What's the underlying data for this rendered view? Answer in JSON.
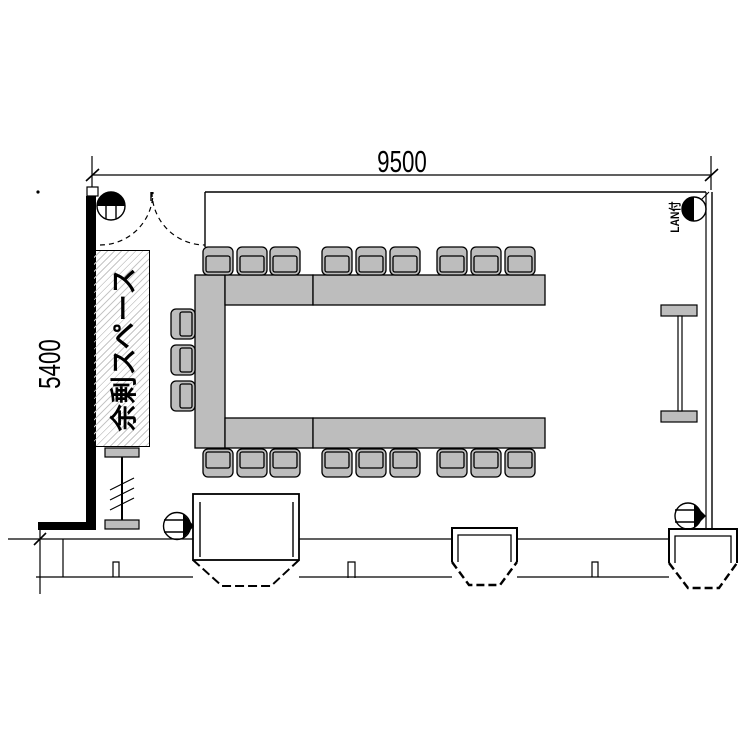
{
  "drawing_type": "meeting-room floor plan",
  "dimensions": {
    "width_label": "9500",
    "height_label": "5400"
  },
  "labels": {
    "surplus_space": "余剰スペース",
    "lan_port": "LAN付"
  },
  "colors": {
    "furniture": "#bdbdbd",
    "wall": "#000000",
    "hatch": "#c6c6c6",
    "background": "#ffffff"
  },
  "furniture": {
    "table_shape": "U-shape open to the right",
    "table_units": [
      [
        195,
        275,
        30,
        173
      ],
      [
        225,
        275,
        88,
        30
      ],
      [
        313,
        275,
        232,
        30
      ],
      [
        225,
        418,
        88,
        30
      ],
      [
        313,
        418,
        232,
        30
      ]
    ],
    "chair_count": 21,
    "chair_rows": [
      {
        "name": "top-row",
        "facing": "down",
        "y": 247,
        "w": 30,
        "h": 28,
        "xs": [
          203,
          237,
          270,
          322,
          356,
          390,
          437,
          471,
          505
        ]
      },
      {
        "name": "bottom-row",
        "facing": "up",
        "y": 449,
        "w": 30,
        "h": 28,
        "xs": [
          203,
          237,
          270,
          322,
          356,
          390,
          437,
          471,
          505
        ]
      },
      {
        "name": "left-column",
        "facing": "right",
        "x": 171,
        "w": 24,
        "h": 30,
        "ys": [
          309,
          345,
          381
        ]
      }
    ]
  },
  "features": {
    "door": "double swing door, top-left",
    "bay_windows": 3,
    "columns": "I-beam symbols left-bottom and right-middle",
    "outlet_symbols": 4
  }
}
